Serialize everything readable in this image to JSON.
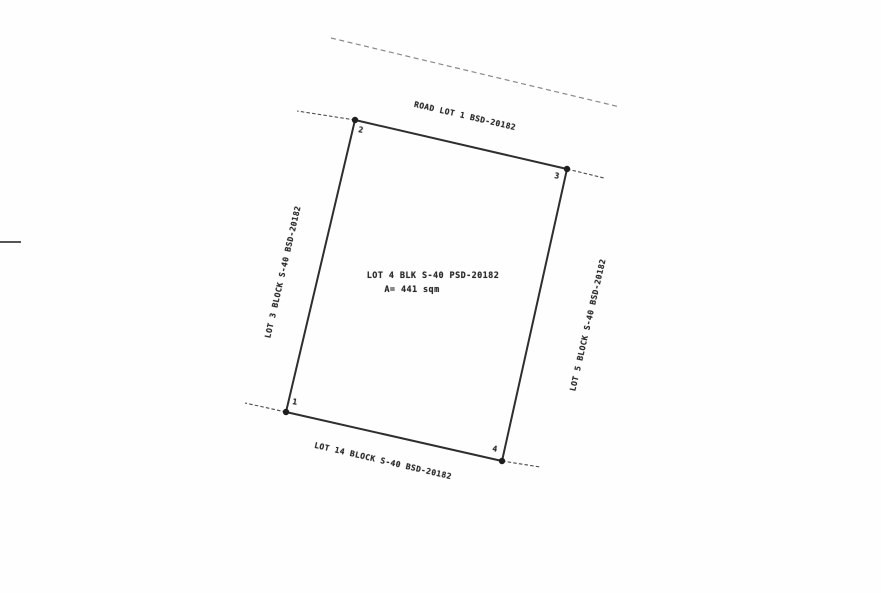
{
  "labels": {
    "road": "ROAD LOT 1 BSD-20182",
    "center_line1": "LOT 4 BLK S-40 PSD-20182",
    "center_line2": "A= 441 sqm",
    "lot_left": "LOT 3 BLOCK S-40 BSD-20182",
    "lot_right": "LOT 5 BLOCK S-40 BSD-20182",
    "lot_bottom": "LOT 14 BLOCK S-40 BSD-20182"
  },
  "corners": [
    {
      "label": "1"
    },
    {
      "label": "2"
    },
    {
      "label": "3"
    },
    {
      "label": "4"
    }
  ],
  "colors": {
    "boundary_line": "#2e2e2e",
    "dashed_line": "#4a4a4a",
    "road_dashed_line": "#6b6b6b",
    "text": "#2b2b2b",
    "background": "#fefefe"
  }
}
